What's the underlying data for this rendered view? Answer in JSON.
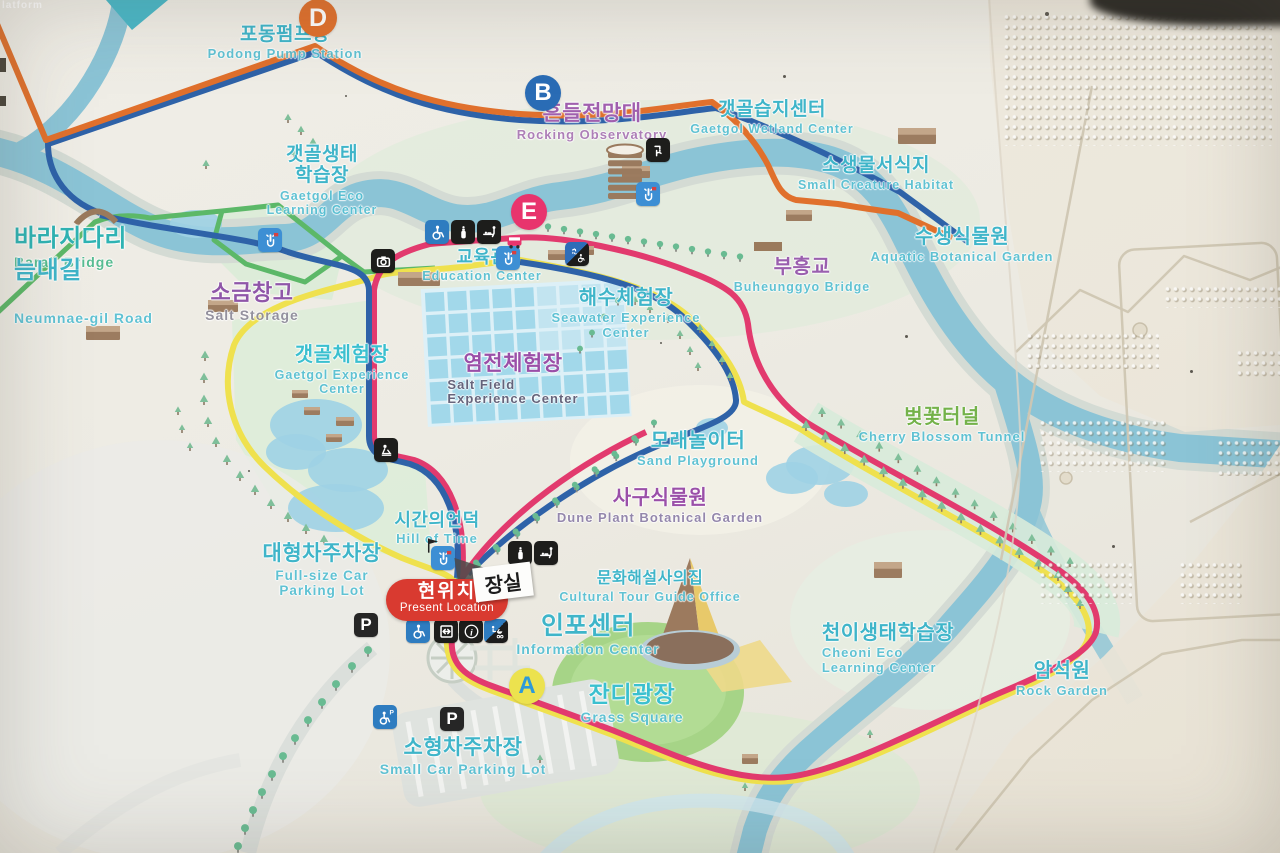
{
  "photo": {
    "subject": "tactile park guide map sign with braille panel"
  },
  "partial_edge_label": {
    "text": "latform"
  },
  "present_location": {
    "ko": "현위치",
    "en": "Present Location"
  },
  "toilet_sign": {
    "text": "장실"
  },
  "colors": {
    "route_orange": "#e0702c",
    "route_blue": "#2e62a8",
    "route_pink": "#e23a6e",
    "route_yellow": "#efe14e",
    "route_green": "#5cb868",
    "river": "#8bc4d6",
    "river_bank": "#d4dbd4",
    "present_red": "#d93a30",
    "label_cyan": "#3fb5c9",
    "label_cyan_en": "#55bfd2",
    "label_purple": "#9a57ac",
    "grass": "#a6d487"
  },
  "markers": [
    {
      "letter": "D",
      "x": 318,
      "y": 18,
      "bg": "#e0702c",
      "fg": "#ffffff",
      "r": 19
    },
    {
      "letter": "B",
      "x": 543,
      "y": 93,
      "bg": "#2a6cb5",
      "fg": "#ffffff",
      "r": 18
    },
    {
      "letter": "E",
      "x": 529,
      "y": 212,
      "bg": "#e8346d",
      "fg": "#ffffff",
      "r": 18
    },
    {
      "letter": "A",
      "x": 527,
      "y": 686,
      "bg": "#ece24e",
      "fg": "#2e9ad8",
      "r": 18
    }
  ],
  "labels": [
    {
      "id": "podong-pump-station",
      "ko": "포동펌프장",
      "en": "Podong Pump Station",
      "x": 285,
      "y": 24,
      "koColor": "#3fb5c9",
      "enColor": "#55bfd2",
      "koSize": 19,
      "enSize": 13
    },
    {
      "id": "rocking-observatory",
      "ko": "흔들전망대",
      "en": "Rocking Observatory",
      "x": 592,
      "y": 102,
      "koColor": "#a05fae",
      "enColor": "#a976b4",
      "koSize": 21,
      "enSize": 13
    },
    {
      "id": "gaetgol-wetland-center",
      "ko": "갯골습지센터",
      "en": "Gaetgol Wetland Center",
      "x": 772,
      "y": 99,
      "koColor": "#3fb5c9",
      "enColor": "#55bfd2",
      "koSize": 19,
      "enSize": 12.5
    },
    {
      "id": "gaetgol-eco-learning-center",
      "ko": "갯골생태\n학습장",
      "en": "Gaetgol Eco\nLearning Center",
      "x": 322,
      "y": 144,
      "koColor": "#3fb5c9",
      "enColor": "#55bfd2",
      "koSize": 19,
      "enSize": 12.5
    },
    {
      "id": "small-creature-habitat",
      "ko": "소생물서식지",
      "en": "Small Creature Habitat",
      "x": 876,
      "y": 155,
      "koColor": "#3fb5c9",
      "enColor": "#55bfd2",
      "koSize": 19,
      "enSize": 12.5
    },
    {
      "id": "baraji-bridge",
      "ko": "바라지다리",
      "en": "Baraji Bridge",
      "x": 14,
      "y": 226,
      "koColor": "#2fb3b3",
      "enColor": "#4bb98b",
      "koSize": 24,
      "enSize": 14,
      "align": "left"
    },
    {
      "id": "aquatic-botanical-garden",
      "ko": "수생식물원",
      "en": "Aquatic Botanical Garden",
      "x": 962,
      "y": 226,
      "koColor": "#3fb5c9",
      "enColor": "#55bfd2",
      "koSize": 20,
      "enSize": 13
    },
    {
      "id": "education-center",
      "ko": "교육관",
      "en": "Education Center",
      "x": 482,
      "y": 247,
      "koColor": "#3fb5c9",
      "enColor": "#55bfd2",
      "koSize": 18,
      "enSize": 12.5
    },
    {
      "id": "buheunggyo-bridge",
      "ko": "부흥교",
      "en": "Buheunggyo Bridge",
      "x": 802,
      "y": 256,
      "koColor": "#9a5fae",
      "enColor": "#55bfd2",
      "koSize": 20,
      "enSize": 12.5
    },
    {
      "id": "salt-storage",
      "ko": "소금창고",
      "en": "Salt Storage",
      "x": 252,
      "y": 281,
      "koColor": "#8f56a8",
      "enColor": "#8d8a99",
      "koSize": 22,
      "enSize": 14
    },
    {
      "id": "neumnae-gil-road",
      "ko": "늠내길",
      "en": "Neumnae-gil Road",
      "x": 14,
      "y": 258,
      "koColor": "#3fb5c9",
      "enColor": "#55bfd2",
      "koSize": 24,
      "enSize": 14,
      "align": "left",
      "gap": 26
    },
    {
      "id": "seawater-experience-center",
      "ko": "해수체험장",
      "en": "Seawater Experience\nCenter",
      "x": 626,
      "y": 287,
      "koColor": "#3fb5c9",
      "enColor": "#55bfd2",
      "koSize": 20,
      "enSize": 13
    },
    {
      "id": "gaetgol-experience-center",
      "ko": "갯골체험장",
      "en": "Gaetgol Experience\nCenter",
      "x": 342,
      "y": 344,
      "koColor": "#3bc0cf",
      "enColor": "#55bfd2",
      "koSize": 20,
      "enSize": 12.5
    },
    {
      "id": "salt-field-experience-center",
      "ko": "염전체험장",
      "en": "Salt Field\nExperience Center",
      "x": 513,
      "y": 352,
      "koColor": "#9a4fa8",
      "enColor": "#5e5a72",
      "koSize": 21,
      "enSize": 13,
      "enLeft": true
    },
    {
      "id": "sand-playground",
      "ko": "모래놀이터",
      "en": "Sand Playground",
      "x": 698,
      "y": 430,
      "koColor": "#3fb5c9",
      "enColor": "#55bfd2",
      "koSize": 20,
      "enSize": 13
    },
    {
      "id": "cherry-blossom-tunnel",
      "ko": "벚꽃터널",
      "en": "Cherry Blossom Tunnel",
      "x": 942,
      "y": 406,
      "koColor": "#74b24a",
      "enColor": "#55bfd2",
      "koSize": 20,
      "enSize": 13
    },
    {
      "id": "dune-plant-botanical-garden",
      "ko": "사구식물원",
      "en": "Dune Plant Botanical Garden",
      "x": 660,
      "y": 487,
      "koColor": "#9a4fa8",
      "enColor": "#8d7fa8",
      "koSize": 20,
      "enSize": 13
    },
    {
      "id": "hill-of-time",
      "ko": "시간의언덕",
      "en": "Hill of Time",
      "x": 437,
      "y": 510,
      "koColor": "#3fb5c9",
      "enColor": "#55bfd2",
      "koSize": 18,
      "enSize": 13
    },
    {
      "id": "full-size-car-parking-lot",
      "ko": "대형차주차장",
      "en": "Full-size Car\nParking Lot",
      "x": 322,
      "y": 542,
      "koColor": "#3fb5c9",
      "enColor": "#55bfd2",
      "koSize": 21,
      "enSize": 13.5
    },
    {
      "id": "cultural-tour-guide-office",
      "ko": "문화해설사의집",
      "en": "Cultural Tour Guide Office",
      "x": 650,
      "y": 570,
      "koColor": "#3fb5c9",
      "enColor": "#55bfd2",
      "koSize": 16,
      "enSize": 12.5
    },
    {
      "id": "information-center",
      "ko": "인포센터",
      "en": "Information Center",
      "x": 588,
      "y": 612,
      "koColor": "#3fb5c9",
      "enColor": "#55bfd2",
      "koSize": 25,
      "enSize": 14
    },
    {
      "id": "cheoni-eco-learning-center",
      "ko": "천이생태학습장",
      "en": "Cheoni Eco\nLearning Center",
      "x": 888,
      "y": 622,
      "koColor": "#3fb5c9",
      "enColor": "#55bfd2",
      "koSize": 20,
      "enSize": 13,
      "enLeft": true
    },
    {
      "id": "grass-square",
      "ko": "잔디광장",
      "en": "Grass Square",
      "x": 632,
      "y": 682,
      "koColor": "#3bc0cf",
      "enColor": "#55bfd2",
      "koSize": 23,
      "enSize": 14
    },
    {
      "id": "rock-garden",
      "ko": "암석원",
      "en": "Rock Garden",
      "x": 1062,
      "y": 660,
      "koColor": "#3fb5c9",
      "enColor": "#55bfd2",
      "koSize": 20,
      "enSize": 13
    },
    {
      "id": "small-car-parking-lot",
      "ko": "소형차주차장",
      "en": "Small Car Parking Lot",
      "x": 463,
      "y": 736,
      "koColor": "#3fb5c9",
      "enColor": "#55bfd2",
      "koSize": 21,
      "enSize": 14
    }
  ],
  "icons": [
    {
      "name": "touch-point-icon",
      "x": 270,
      "y": 240
    },
    {
      "name": "touch-point-icon",
      "x": 508,
      "y": 258
    },
    {
      "name": "touch-point-icon",
      "x": 648,
      "y": 194
    },
    {
      "name": "touch-point-icon",
      "x": 443,
      "y": 558
    },
    {
      "name": "drinking-fountain-icon",
      "x": 658,
      "y": 150
    },
    {
      "name": "wheelchair-icon",
      "x": 437,
      "y": 232
    },
    {
      "name": "nursing-room-icon",
      "x": 463,
      "y": 232
    },
    {
      "name": "diaper-change-icon",
      "x": 489,
      "y": 232
    },
    {
      "name": "shuttle-bus-icon",
      "x": 514,
      "y": 241
    },
    {
      "name": "shower-accessible-icon",
      "x": 577,
      "y": 254
    },
    {
      "name": "camera-icon",
      "x": 383,
      "y": 261
    },
    {
      "name": "experience-spot-icon",
      "x": 386,
      "y": 450
    },
    {
      "name": "nursing-room-icon",
      "x": 520,
      "y": 553
    },
    {
      "name": "diaper-change-icon",
      "x": 546,
      "y": 553
    },
    {
      "name": "wheelchair-icon",
      "x": 418,
      "y": 631
    },
    {
      "name": "elevator-icon",
      "x": 446,
      "y": 631
    },
    {
      "name": "info-icon",
      "x": 471,
      "y": 631
    },
    {
      "name": "stroller-accessible-icon",
      "x": 496,
      "y": 631
    },
    {
      "name": "parking-icon",
      "x": 366,
      "y": 625
    },
    {
      "name": "accessible-parking-icon",
      "x": 385,
      "y": 717
    },
    {
      "name": "parking-icon",
      "x": 452,
      "y": 719
    },
    {
      "name": "flag-icon",
      "x": 432,
      "y": 545
    }
  ]
}
